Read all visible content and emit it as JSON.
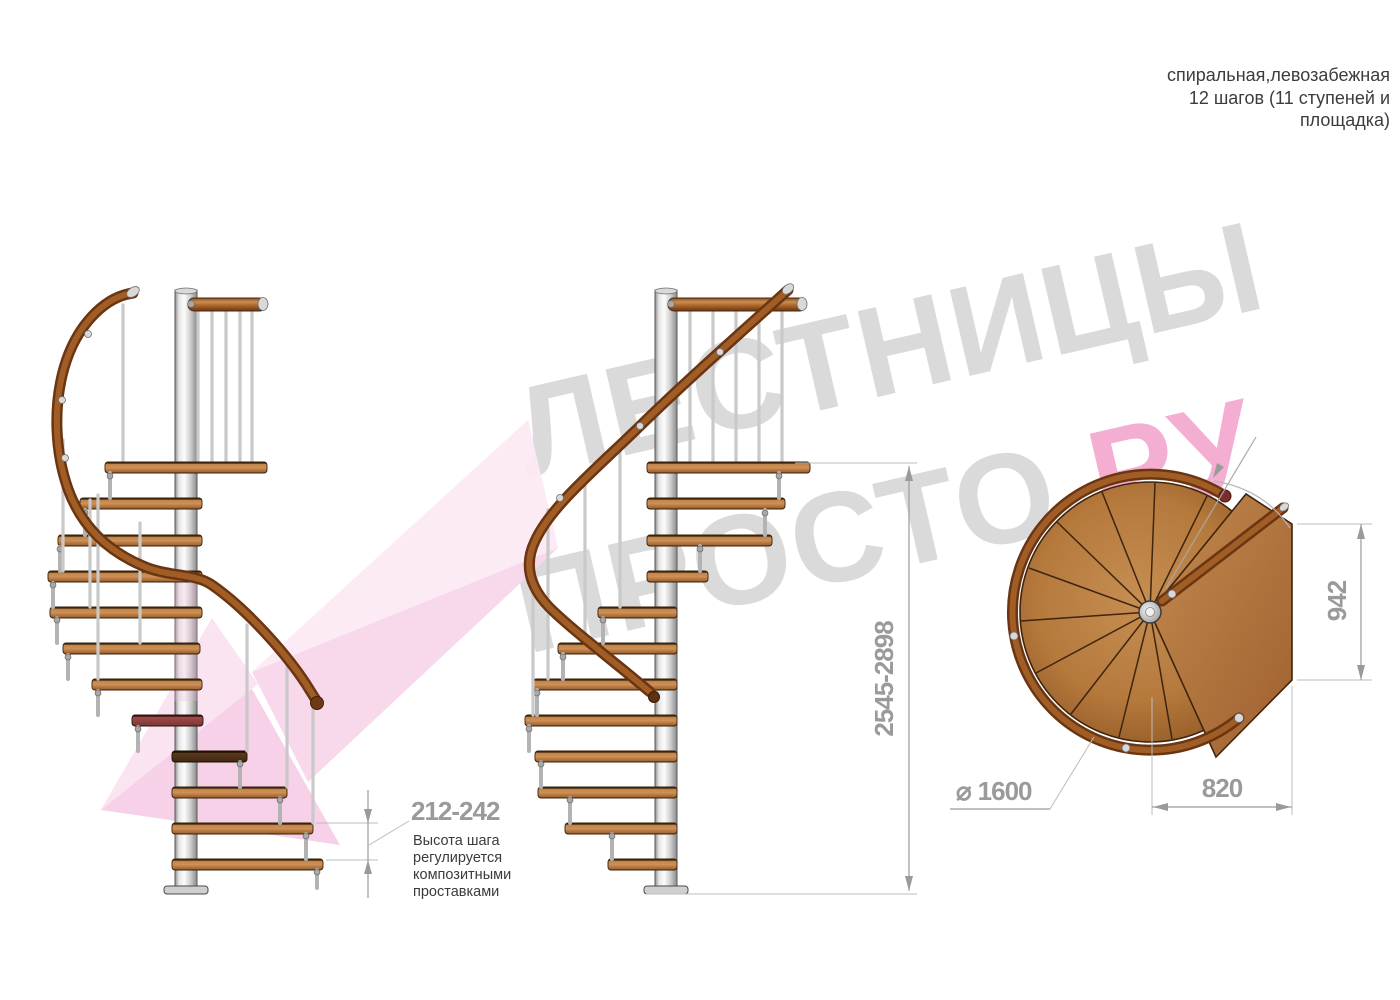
{
  "title_block": {
    "line1": "спиральная,левозабежная",
    "line2": "12 шагов (11 ступеней и",
    "line3": "площадка)"
  },
  "watermark": {
    "brand_word1": "ЛЕСТНИЦЫ",
    "brand_word2": "ПРОСТО",
    "brand_suffix": ".РУ"
  },
  "annotations": {
    "step_height": {
      "value": "212-242",
      "note1": "Высота шага",
      "note2": "регулируется",
      "note3": "композитными",
      "note4": "проставками"
    },
    "total_height": {
      "value": "2545-2898"
    },
    "platform_depth": {
      "value": "942"
    },
    "platform_width": {
      "value": "820"
    },
    "diameter": {
      "symbol": "⌀",
      "value": "1600"
    }
  },
  "colors": {
    "wood": "#b5793c",
    "handrail": "#6b3511",
    "metal": "#d9d9d9",
    "dimension_gray": "#9a9a9a",
    "note_text": "#3b3b3b",
    "watermark_gray": "#dadada",
    "watermark_pink": "#f3aed2",
    "arrow_pink": "#f8d7ec"
  }
}
